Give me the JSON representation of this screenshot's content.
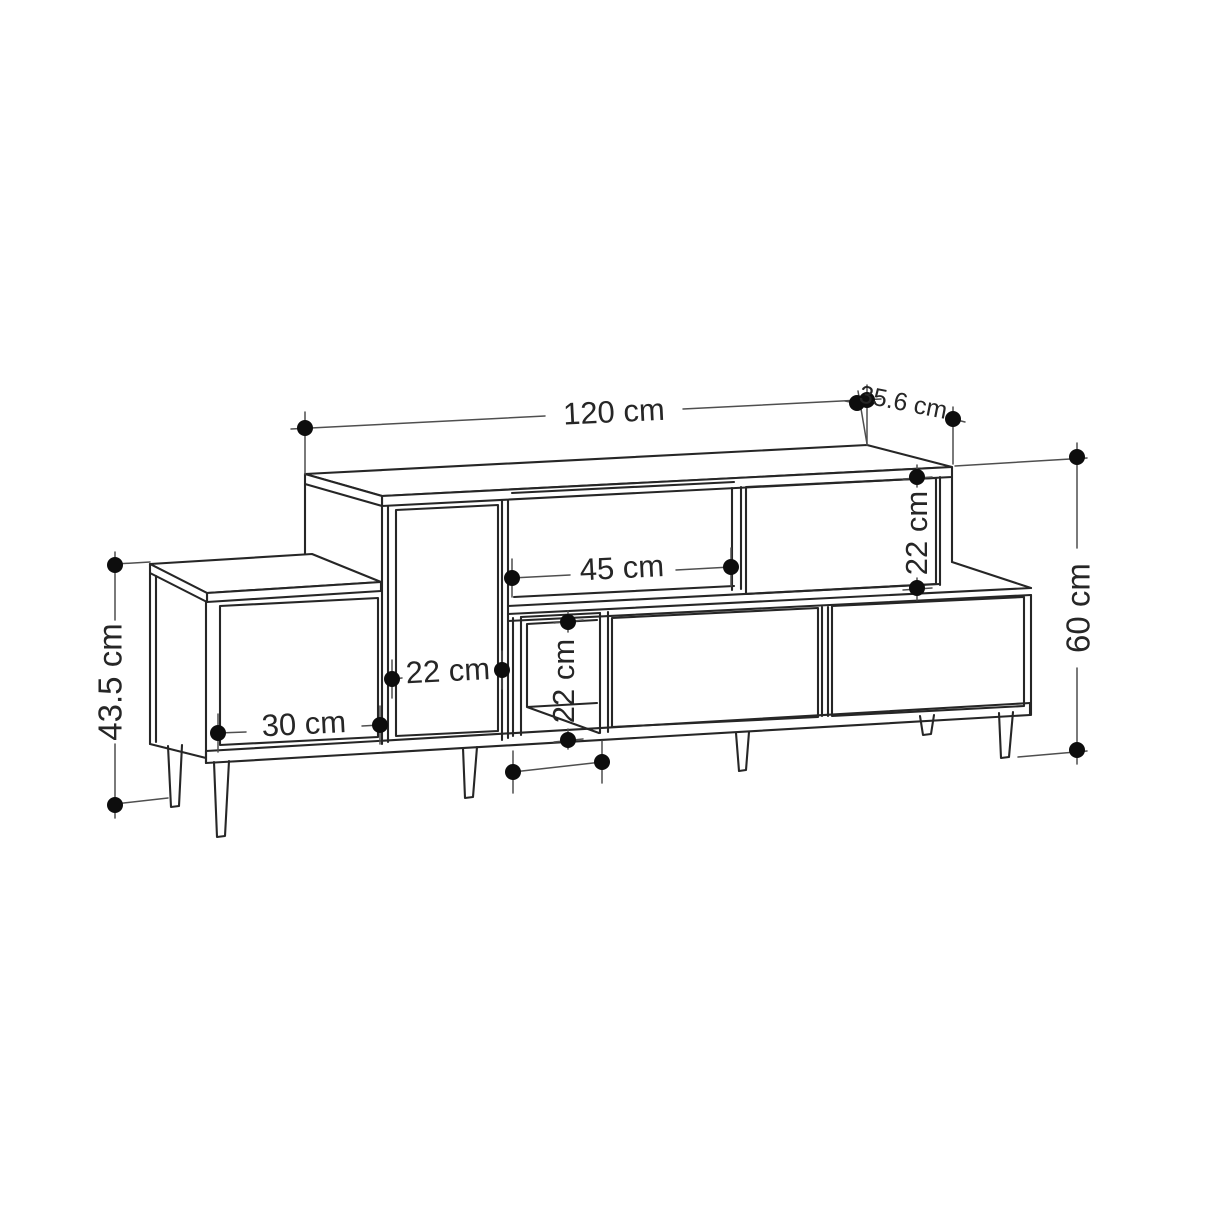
{
  "diagram": {
    "type": "furniture-dimension-drawing",
    "subject": "TV stand line drawing with dimension annotations",
    "unit": "cm",
    "colors": {
      "background": "#ffffff",
      "structure_line": "#262626",
      "dimension_line": "#4f4f4f",
      "endpoint_dot": "#0d0d0d",
      "label_text": "#262626"
    },
    "dimensions": [
      {
        "id": "top-width",
        "label": "120 cm",
        "value": 120,
        "orientation": "horizontal"
      },
      {
        "id": "top-depth",
        "label": "35.6 cm",
        "value": 35.6,
        "orientation": "depth"
      },
      {
        "id": "upper-right-compartment-height",
        "label": "22 cm",
        "value": 22,
        "orientation": "vertical"
      },
      {
        "id": "middle-shelf-width",
        "label": "45 cm",
        "value": 45,
        "orientation": "horizontal"
      },
      {
        "id": "total-height",
        "label": "60 cm",
        "value": 60,
        "orientation": "vertical"
      },
      {
        "id": "center-door-width",
        "label": "22 cm",
        "value": 22,
        "orientation": "horizontal"
      },
      {
        "id": "left-door-width",
        "label": "30 cm",
        "value": 30,
        "orientation": "horizontal"
      },
      {
        "id": "lower-compartment-height",
        "label": "22 cm",
        "value": 22,
        "orientation": "vertical"
      },
      {
        "id": "left-section-height",
        "label": "43.5 cm",
        "value": 43.5,
        "orientation": "vertical"
      }
    ]
  }
}
